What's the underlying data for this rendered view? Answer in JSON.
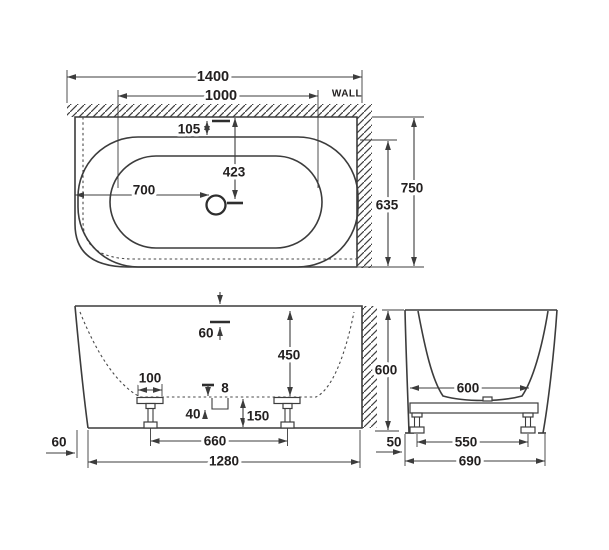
{
  "drawing": {
    "type": "bathtub-installation-dimension-diagram",
    "colors": {
      "line": "#3c3c3c",
      "text": "#232020",
      "background": "#ffffff"
    },
    "plan": {
      "wall_label": "WALL",
      "overall_length": "1400",
      "length_to_wall": "1000",
      "rim_inset": "105",
      "drain_to_wall": "423",
      "drain_to_end": "700",
      "basin_depth": "635",
      "overall_depth": "750"
    },
    "front": {
      "rim_thickness": "60",
      "basin_depth": "450",
      "foot_plate_width": "100",
      "recess_width": "8",
      "recess_depth": "40",
      "base_clearance": "150",
      "feet_spacing": "660",
      "base_length": "1280",
      "end_inset": "60"
    },
    "side": {
      "overall_height": "600",
      "basin_width": "600",
      "skirt_offset": "50",
      "feet_spacing": "550",
      "overall_width": "690"
    }
  }
}
